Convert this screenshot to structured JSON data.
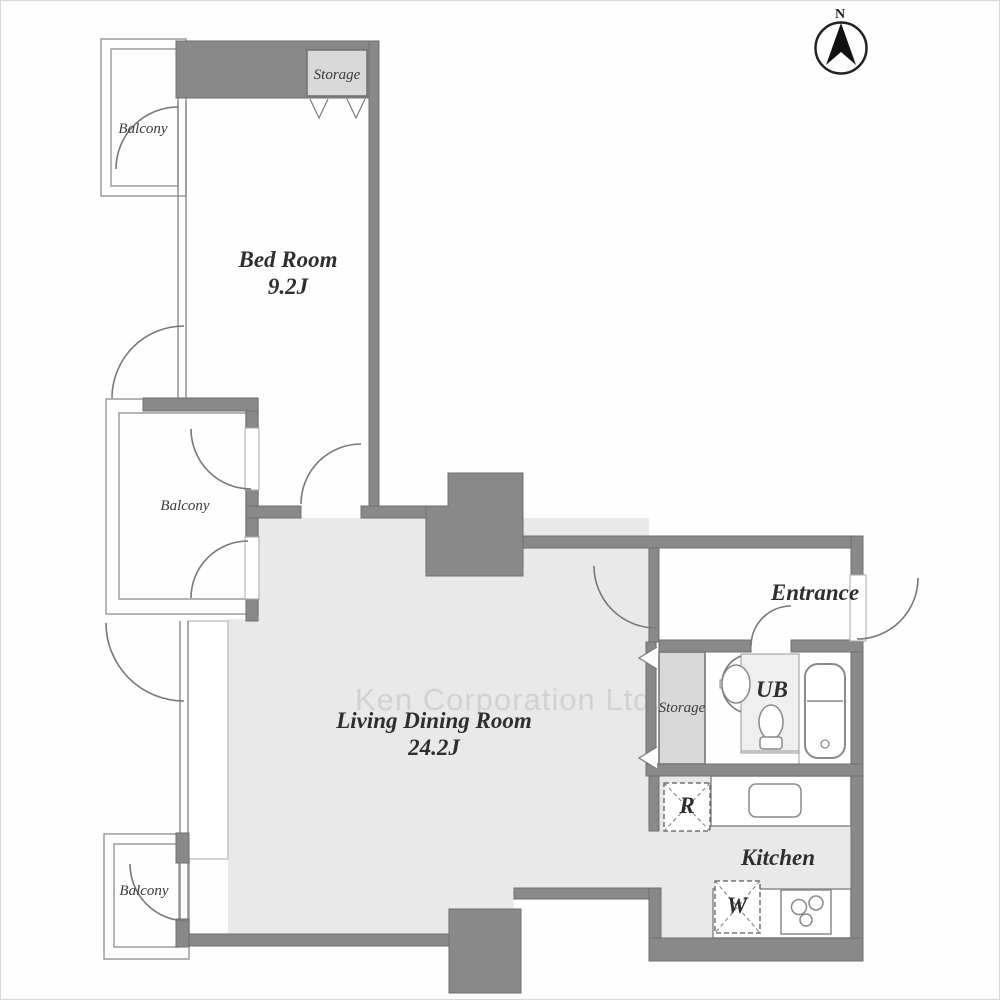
{
  "title": "Apartment floor plan",
  "compass": {
    "label": "N"
  },
  "watermark": "Ken Corporation Ltd.",
  "rooms": {
    "bedroom": {
      "name": "Bed Room",
      "size": "9.2J"
    },
    "living_dining": {
      "name": "Living Dining Room",
      "size": "24.2J"
    },
    "kitchen": {
      "name": "Kitchen"
    },
    "entrance": {
      "name": "Entrance"
    },
    "unit_bath": {
      "name": "UB"
    },
    "storage_bedroom": {
      "name": "Storage"
    },
    "storage_washroom": {
      "name": "Storage"
    },
    "balcony_top": {
      "name": "Balcony"
    },
    "balcony_middle": {
      "name": "Balcony"
    },
    "balcony_bottom": {
      "name": "Balcony"
    }
  },
  "fixtures": {
    "refrigerator": "R",
    "washer": "W"
  },
  "colors": {
    "wall": "#898989",
    "floor": "#e9e9e9",
    "storage_fill": "#d9d9d9",
    "watermark_text": "#d2d2d2"
  }
}
